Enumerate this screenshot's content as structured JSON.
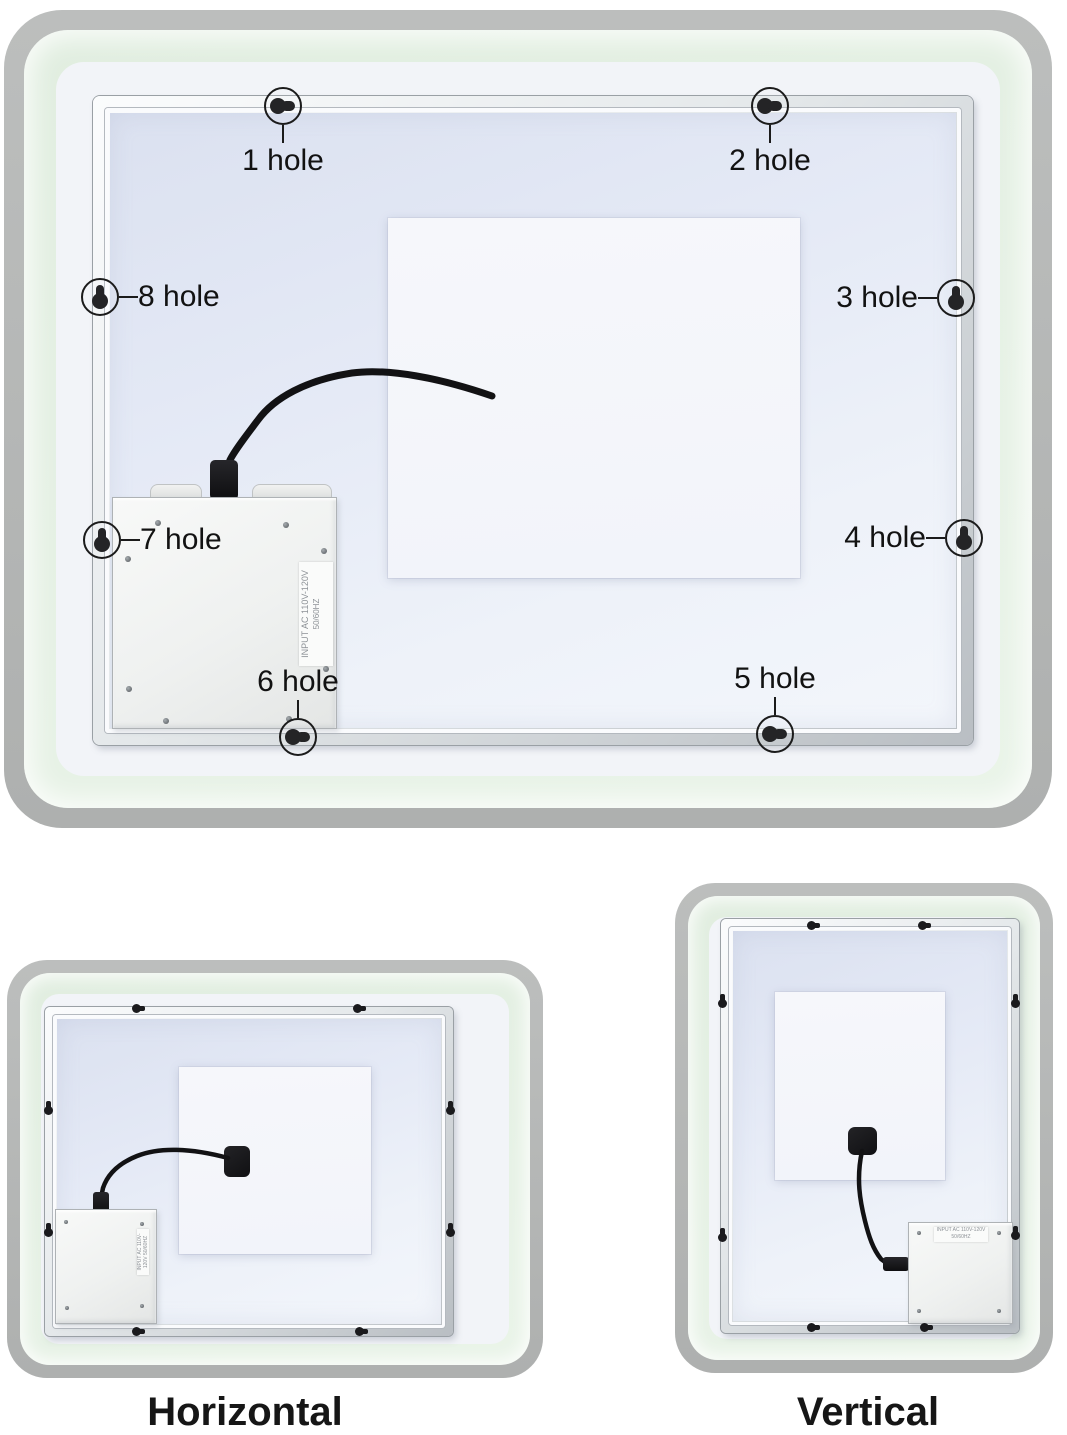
{
  "main_figure": {
    "holes": [
      {
        "label": "1 hole"
      },
      {
        "label": "2 hole"
      },
      {
        "label": "3 hole"
      },
      {
        "label": "4 hole"
      },
      {
        "label": "5 hole"
      },
      {
        "label": "6 hole"
      },
      {
        "label": "7 hole"
      },
      {
        "label": "8 hole"
      }
    ],
    "driver_box_label": {
      "line1": "INPUT AC 110V-120V",
      "line2": "50/60HZ"
    }
  },
  "horizontal_figure": {
    "caption": "Horizontal",
    "driver_box_label": "INPUT AC 110V-120V 50/60HZ"
  },
  "vertical_figure": {
    "caption": "Vertical",
    "driver_box_label": {
      "line1": "INPUT AC 110V-120V",
      "line2": "50/60HZ"
    }
  },
  "colors": {
    "border_gray": "#b5b7b6",
    "mint_green": "#e5f0e4",
    "white_margin": "#f2f4f8",
    "panel_blue": "#e2e7f3",
    "aluminum_light": "#f4f6f7",
    "aluminum_dark": "#b3b8bd",
    "cable_black": "#121214",
    "label_text": "#121212"
  }
}
